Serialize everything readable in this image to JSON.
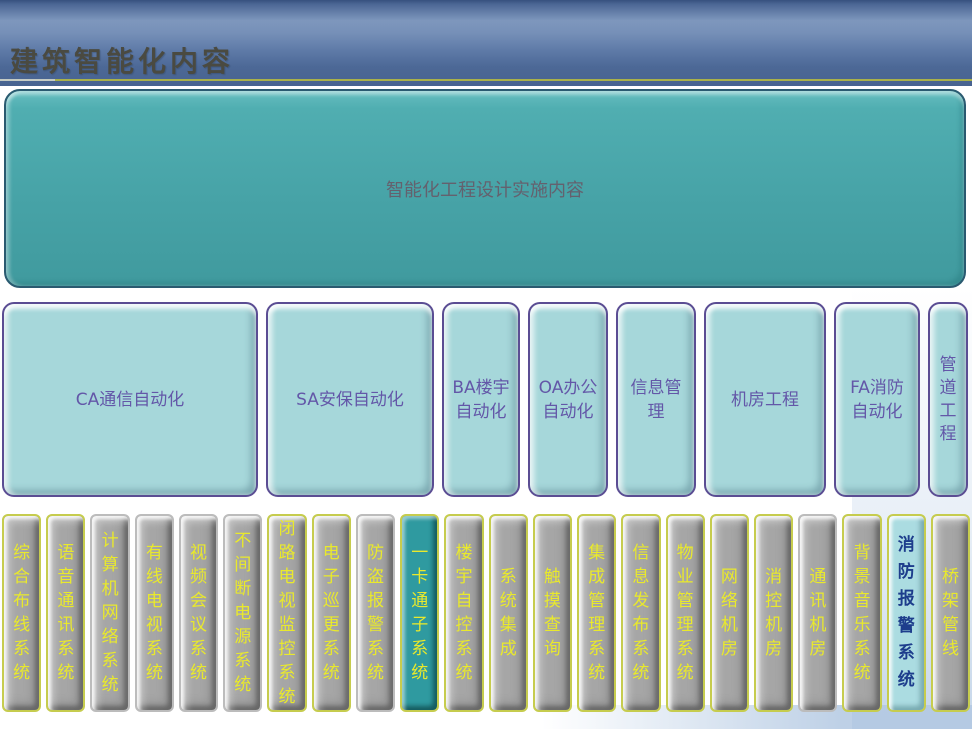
{
  "header": {
    "title": "建筑智能化内容"
  },
  "top_box": {
    "label": "智能化工程设计实施内容"
  },
  "mid_boxes": [
    {
      "label": "CA通信自动化"
    },
    {
      "label": "SA安保自动化"
    },
    {
      "label": "BA楼宇自动化"
    },
    {
      "label": "OA办公自动化"
    },
    {
      "label": "信息管理"
    },
    {
      "label": "机房工程"
    },
    {
      "label": "FA消防自动化"
    },
    {
      "label": "管道工程"
    }
  ],
  "bottom_bars": [
    {
      "label": "综合布线系统",
      "style": "gray",
      "border": "yellow"
    },
    {
      "label": "语音通讯系统",
      "style": "gray",
      "border": "yellow"
    },
    {
      "label": "计算机网络系统",
      "style": "gray",
      "border": "none"
    },
    {
      "label": "有线电视系统",
      "style": "gray",
      "border": "none"
    },
    {
      "label": "视频会议系统",
      "style": "gray",
      "border": "none"
    },
    {
      "label": "不间断电源系统",
      "style": "gray",
      "border": "none"
    },
    {
      "label": "闭路电视监控系统",
      "style": "gray",
      "border": "yellow"
    },
    {
      "label": "电子巡更系统",
      "style": "gray",
      "border": "yellow"
    },
    {
      "label": "防盗报警系统",
      "style": "gray",
      "border": "none"
    },
    {
      "label": "一卡通子系统",
      "style": "teal",
      "border": "yellow"
    },
    {
      "label": "楼宇自控系统",
      "style": "gray",
      "border": "yellow"
    },
    {
      "label": "系统集成",
      "style": "gray",
      "border": "yellow"
    },
    {
      "label": "触摸查询",
      "style": "gray",
      "border": "yellow"
    },
    {
      "label": "集成管理系统",
      "style": "gray",
      "border": "yellow"
    },
    {
      "label": "信息发布系统",
      "style": "gray",
      "border": "yellow"
    },
    {
      "label": "物业管理系统",
      "style": "gray",
      "border": "yellow"
    },
    {
      "label": "网络机房",
      "style": "gray",
      "border": "yellow"
    },
    {
      "label": "消控机房",
      "style": "gray",
      "border": "yellow"
    },
    {
      "label": "通讯机房",
      "style": "gray",
      "border": "none"
    },
    {
      "label": "背景音乐系统",
      "style": "gray",
      "border": "yellow"
    },
    {
      "label": "消防报警系统",
      "style": "cyan",
      "border": "yellow"
    },
    {
      "label": "桥架管线",
      "style": "gray",
      "border": "yellow"
    }
  ],
  "colors": {
    "header_blue": "#7690b8",
    "divider_yellow": "#a9b14a",
    "title_text": "#4a4a41",
    "top_box_teal": "#47a3a7",
    "mid_box_cyan": "#a6d7da",
    "mid_border_purple": "#5b4d93",
    "mid_text_purple": "#6357a8",
    "bar_gray": "#a6a6a6",
    "bar_border_yellow": "#c6cc4e",
    "bar_teal": "#2f9aa0",
    "bar_cyan": "#abdce1",
    "bar_text_yellow": "#e9e92c",
    "bar_text_navy": "#1d3d8c"
  }
}
